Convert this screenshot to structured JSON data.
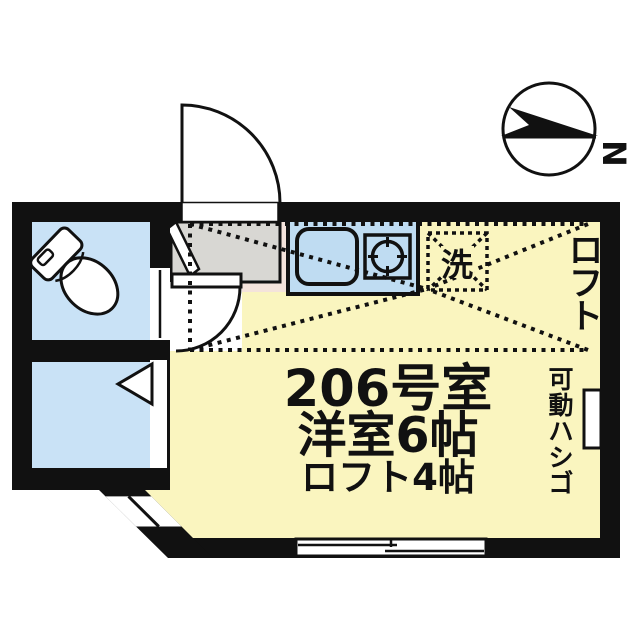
{
  "labels": {
    "room_number": "206号室",
    "room_size": "洋室6帖",
    "loft_size": "ロフト4帖",
    "loft_vertical": "ロフト",
    "ladder_vertical": "可動ハシゴ",
    "washer": "洗",
    "compass_north": "N"
  },
  "colors": {
    "floor": "#FAF5BF",
    "wet_room": "#C9E2F6",
    "kitchen": "#BFDCF2",
    "entrance": "#D8D7D3",
    "hall_accent": "#F4E3DB",
    "wall": "#111111",
    "white": "#FFFFFF"
  }
}
